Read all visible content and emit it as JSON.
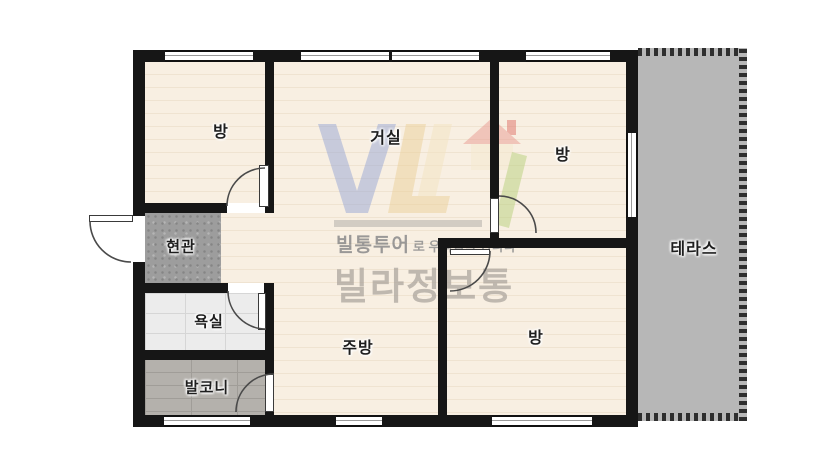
{
  "rooms": [
    {
      "id": "bedroom-top-left",
      "label": "방"
    },
    {
      "id": "living-room",
      "label": "거실"
    },
    {
      "id": "bedroom-top-right",
      "label": "방"
    },
    {
      "id": "terrace",
      "label": "테라스"
    },
    {
      "id": "entrance",
      "label": "현관"
    },
    {
      "id": "bathroom",
      "label": "욕실"
    },
    {
      "id": "balcony",
      "label": "발코니"
    },
    {
      "id": "kitchen",
      "label": "주방"
    },
    {
      "id": "bedroom-bottom-right",
      "label": "방"
    }
  ],
  "watermark": {
    "brand_prefix": "빌통투어",
    "tagline_suffix": "로 우리집을 만나다",
    "brand_name": "빌라정보통"
  },
  "colors": {
    "wall": "#161616",
    "floor": "#f8efe2",
    "floor_line": "#efe3d1",
    "terrace": "#b7b7b7",
    "entrance": "#9d9d9d",
    "bathroom": "#ececec",
    "balcony": "#b4b1ac",
    "label": "#1e1e1e",
    "arc": "#4a4a4a",
    "wm_gray": "#8a8a8a",
    "wm_brand": "#a8a19a"
  }
}
